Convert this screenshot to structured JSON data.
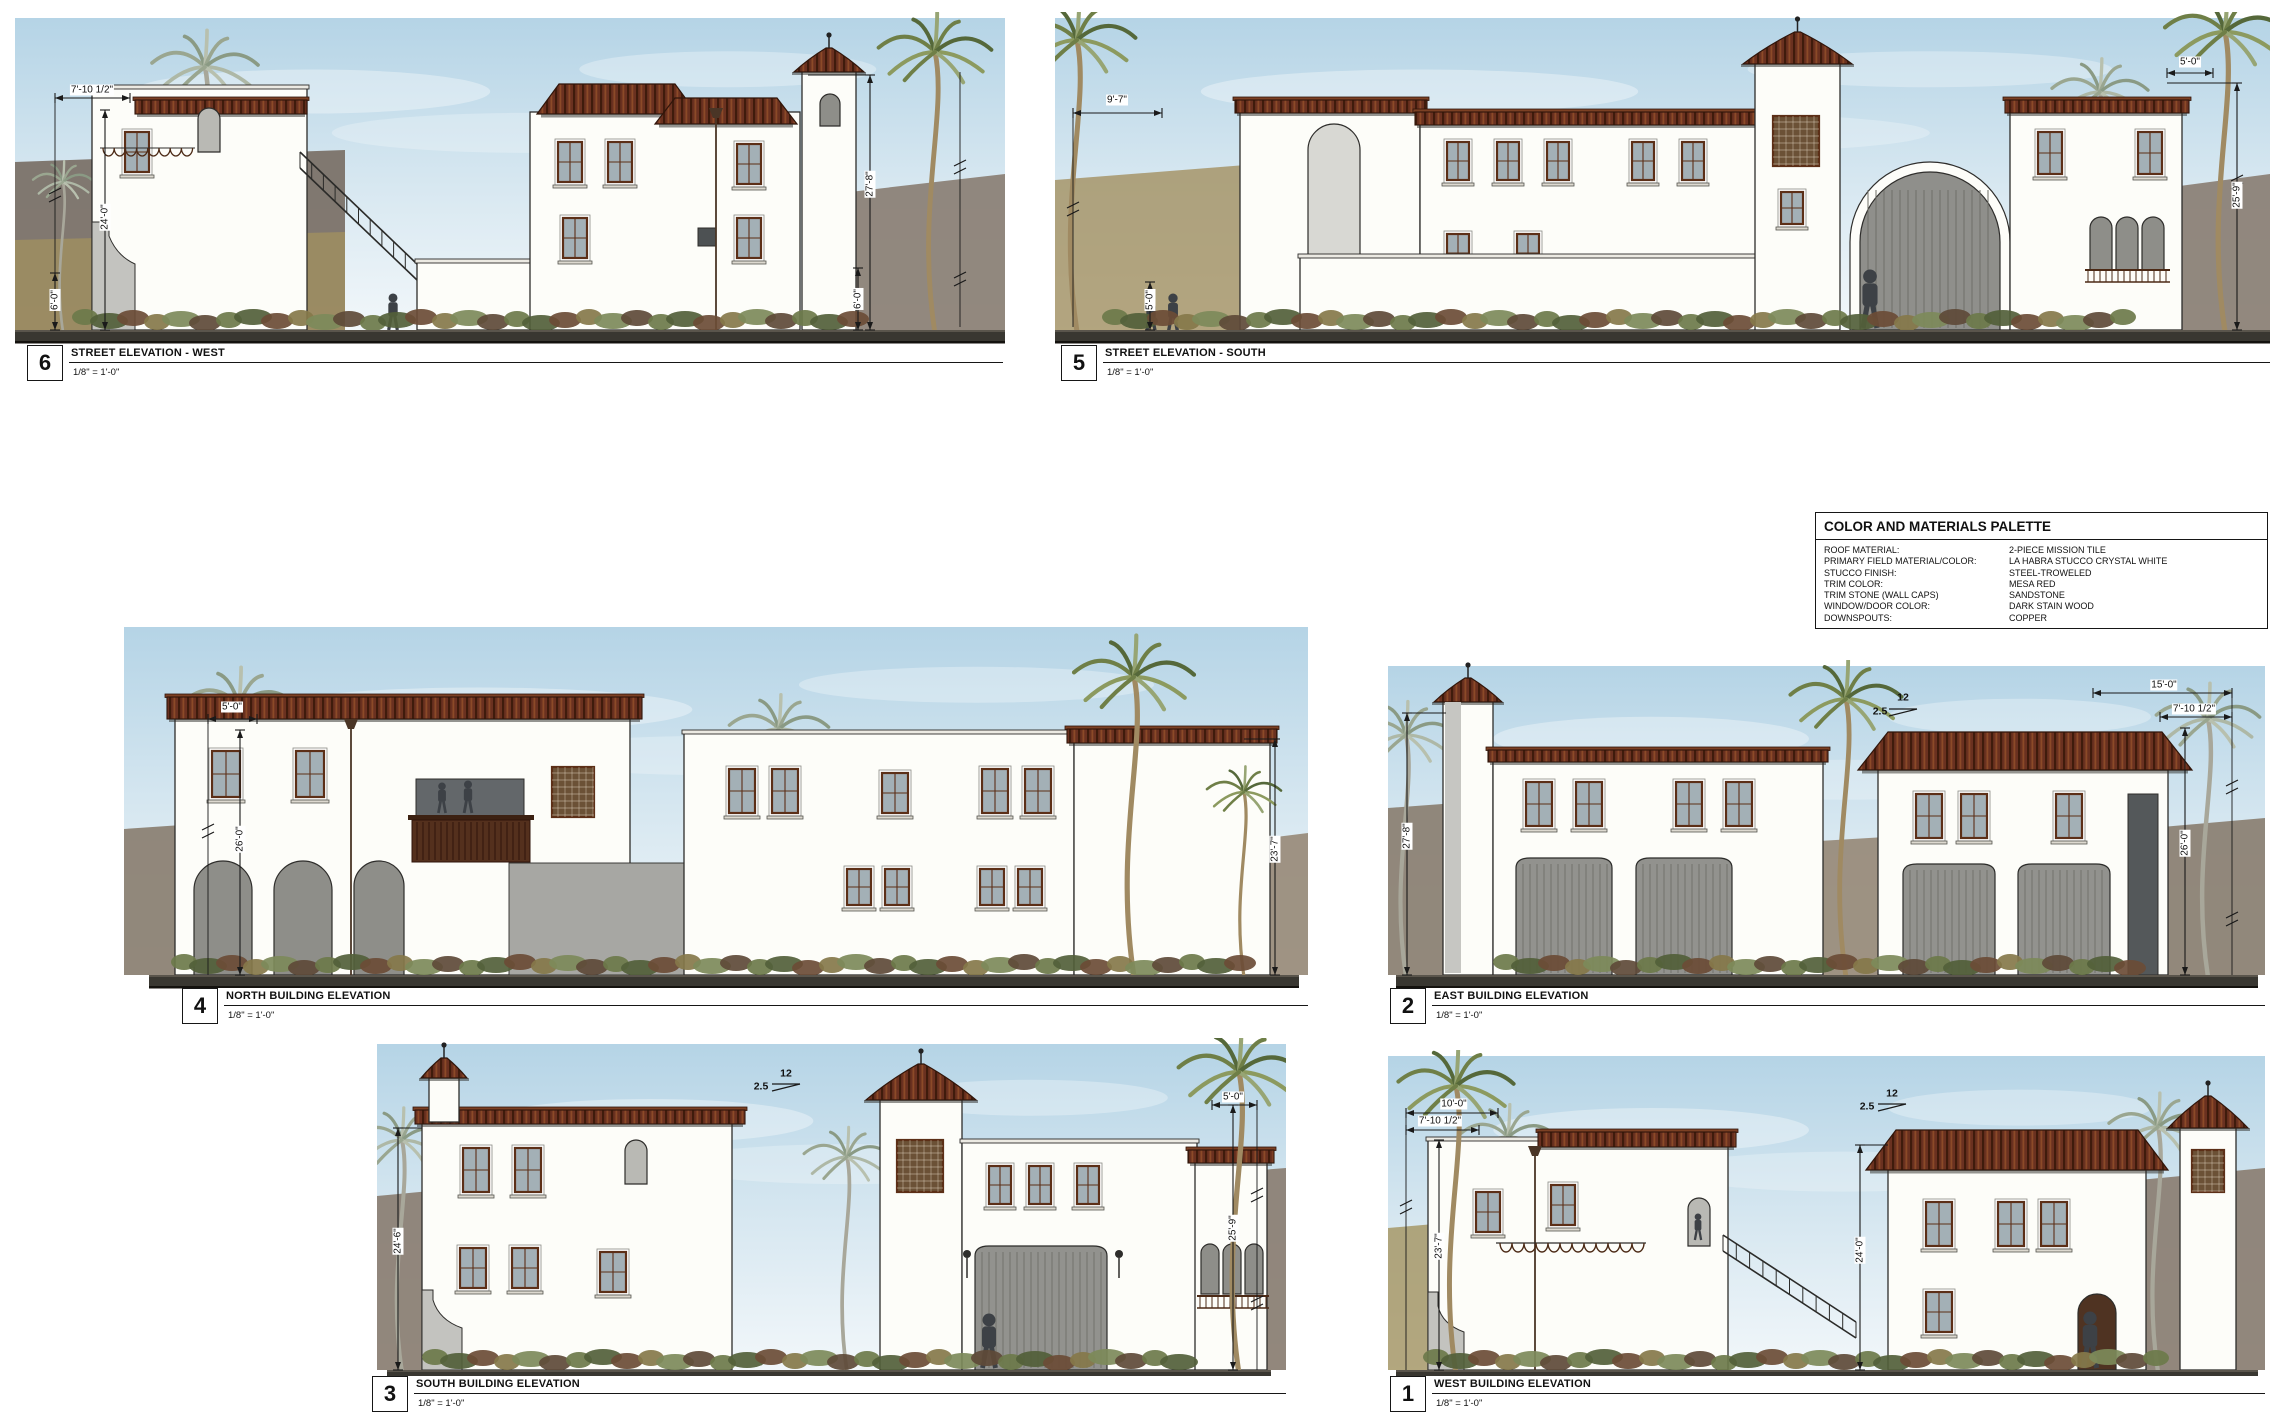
{
  "sheet": {
    "background": "#ffffff"
  },
  "palette_table": {
    "title": "COLOR AND MATERIALS PALETTE",
    "rows": [
      {
        "label": "ROOF MATERIAL:",
        "value": "2-PIECE MISSION TILE"
      },
      {
        "label": "PRIMARY FIELD MATERIAL/COLOR:",
        "value": "LA HABRA STUCCO CRYSTAL WHITE"
      },
      {
        "label": "STUCCO FINISH:",
        "value": "STEEL-TROWELED"
      },
      {
        "label": "TRIM COLOR:",
        "value": "MESA RED"
      },
      {
        "label": "TRIM STONE (WALL CAPS)",
        "value": "SANDSTONE"
      },
      {
        "label": "WINDOW/DOOR COLOR:",
        "value": "DARK STAIN WOOD"
      },
      {
        "label": "DOWNSPOUTS:",
        "value": "COPPER"
      }
    ]
  },
  "panels": [
    {
      "id": "p6",
      "number": "6",
      "title": "STREET ELEVATION - WEST",
      "scale": "1/8\" = 1'-0\"",
      "dims": [
        "7'-10 1/2\"",
        "24'-0\"",
        "6'-0\"",
        "27'-8\"",
        "6'-0\""
      ]
    },
    {
      "id": "p5",
      "number": "5",
      "title": "STREET ELEVATION - SOUTH",
      "scale": "1/8\" = 1'-0\"",
      "dims": [
        "9'-7\"",
        "5'-0\"",
        "5'-0\"",
        "25'-9\""
      ]
    },
    {
      "id": "p4",
      "number": "4",
      "title": "NORTH BUILDING ELEVATION",
      "scale": "1/8\" = 1'-0\"",
      "dims": [
        "5'-0\"",
        "26'-0\"",
        "23'-7\""
      ]
    },
    {
      "id": "p2",
      "number": "2",
      "title": "EAST BUILDING ELEVATION",
      "scale": "1/8\" = 1'-0\"",
      "dims": [
        "27'-8\"",
        "15'-0\"",
        "7'-10 1/2\"",
        "26'-0\"",
        "12",
        "2.5"
      ]
    },
    {
      "id": "p3",
      "number": "3",
      "title": "SOUTH BUILDING ELEVATION",
      "scale": "1/8\" = 1'-0\"",
      "dims": [
        "24'-6\"",
        "5'-0\"",
        "25'-9\"",
        "12",
        "2.5"
      ]
    },
    {
      "id": "p1",
      "number": "1",
      "title": "WEST BUILDING ELEVATION",
      "scale": "1/8\" = 1'-0\"",
      "dims": [
        "10'-0\"",
        "7'-10 1/2\"",
        "23'-7\"",
        "24'-0\"",
        "12",
        "2.5"
      ]
    }
  ],
  "materials_colors": {
    "roof_tile": "#6a3120",
    "stucco_white": "#fdfdf9",
    "trim_wood": "#5c2f17",
    "ground": "#393731",
    "sky": "#cfe3ee"
  }
}
